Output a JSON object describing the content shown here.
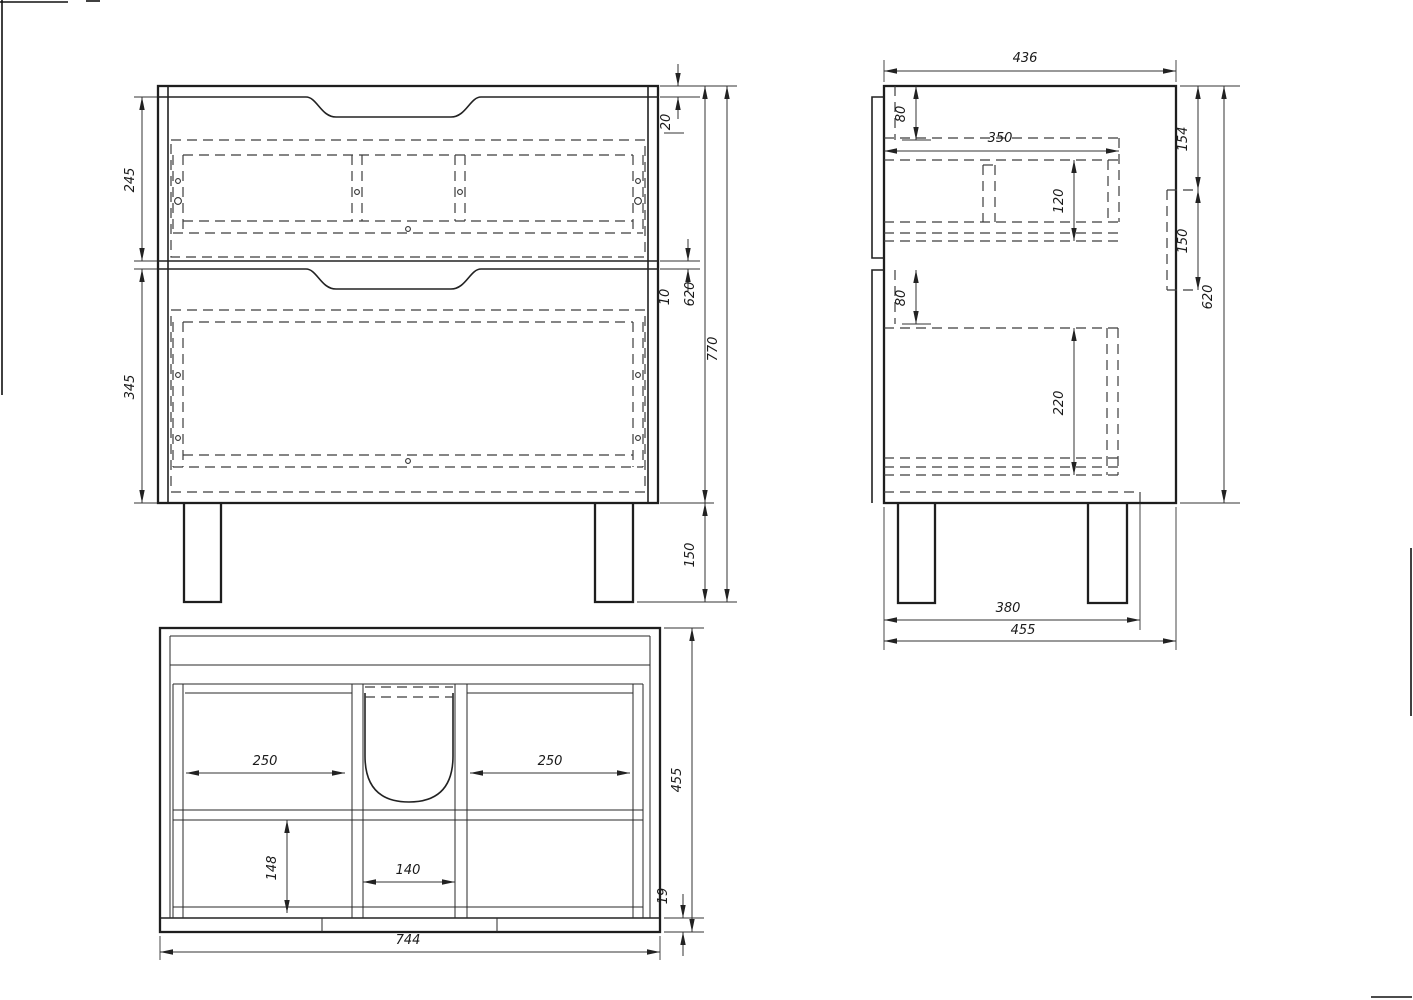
{
  "drawing": {
    "front_view": {
      "dims": {
        "drawer_top_height": "245",
        "drawer_bottom_height": "345",
        "top_gap": "20",
        "mid_gap": "10",
        "body_height": "620",
        "total_height": "770",
        "leg_height": "150"
      }
    },
    "side_view": {
      "dims": {
        "depth_total": "436",
        "rail_top": "80",
        "inner_width": "350",
        "drawer_box_top_height": "120",
        "offset_top": "154",
        "bracket_height": "150",
        "rail_bottom": "80",
        "drawer_box_bottom_height": "220",
        "body_height": "620",
        "leg_span": "380",
        "base_depth": "455"
      }
    },
    "top_view": {
      "dims": {
        "compartment_left": "250",
        "compartment_right": "250",
        "depth_total": "455",
        "compartment_depth": "148",
        "center_width": "140",
        "plinth_thickness": "19",
        "total_width": "744"
      }
    },
    "colors": {
      "line": "#1e1e1e",
      "background": "#ffffff"
    }
  }
}
